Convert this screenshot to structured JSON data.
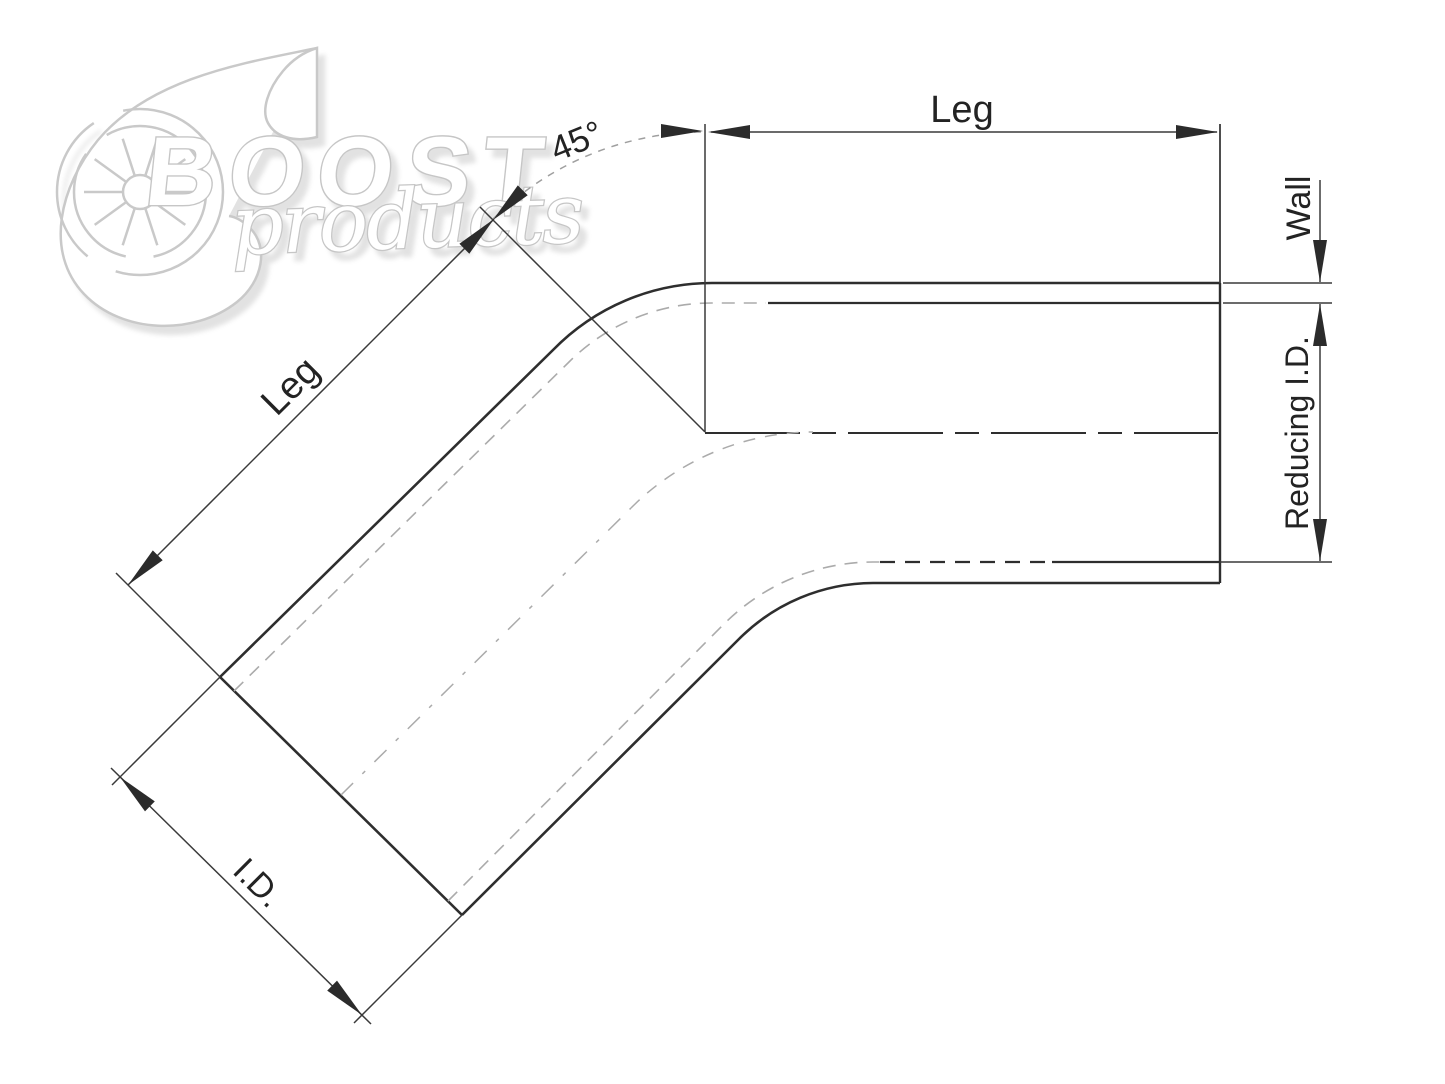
{
  "diagram": {
    "type": "technical-drawing",
    "description": "45-degree reducing elbow with dimension annotations",
    "angle_deg": 45
  },
  "labels": {
    "leg_top": "Leg",
    "leg_diagonal": "Leg",
    "angle": "45°",
    "wall": "Wall",
    "reducing_id": "Reducing I.D.",
    "id": "I.D."
  },
  "logo": {
    "brand": "BOOST",
    "brand_sub": "products"
  },
  "colors": {
    "background": "#ffffff",
    "line_dark": "#2e2e2e",
    "line_light": "#ababab",
    "dimension_line": "#3a3a3a",
    "logo_outline": "#c9c9c9"
  }
}
